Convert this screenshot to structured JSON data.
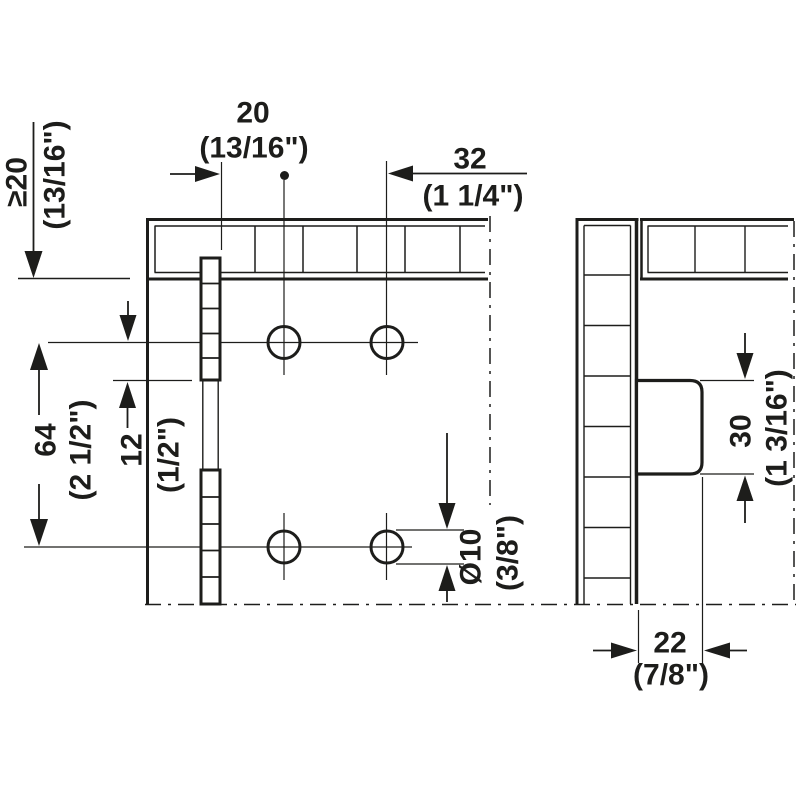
{
  "drawing": {
    "type": "furniture-fitting installation drawing",
    "background": "#ffffff",
    "line_color": "#1d1d1b",
    "dimensions": {
      "min_top_clearance": {
        "mm": "≥20",
        "inch": "(13/16\")"
      },
      "strip_to_hole": {
        "mm": "20",
        "inch": "(13/16\")"
      },
      "hole_to_center": {
        "mm": "32",
        "inch": "(1 1/4\")"
      },
      "hole_row_spacing": {
        "mm": "64",
        "inch": "(2 1/2\")"
      },
      "hole_to_strip_end": {
        "mm": "12",
        "inch": "(1/2\")"
      },
      "hole_diameter": {
        "mm": "Ø10",
        "inch": "(3/8\")"
      },
      "fitting_height": {
        "mm": "30",
        "inch": "(1 3/16\")"
      },
      "fitting_depth": {
        "mm": "22",
        "inch": "(7/8\")"
      }
    }
  }
}
